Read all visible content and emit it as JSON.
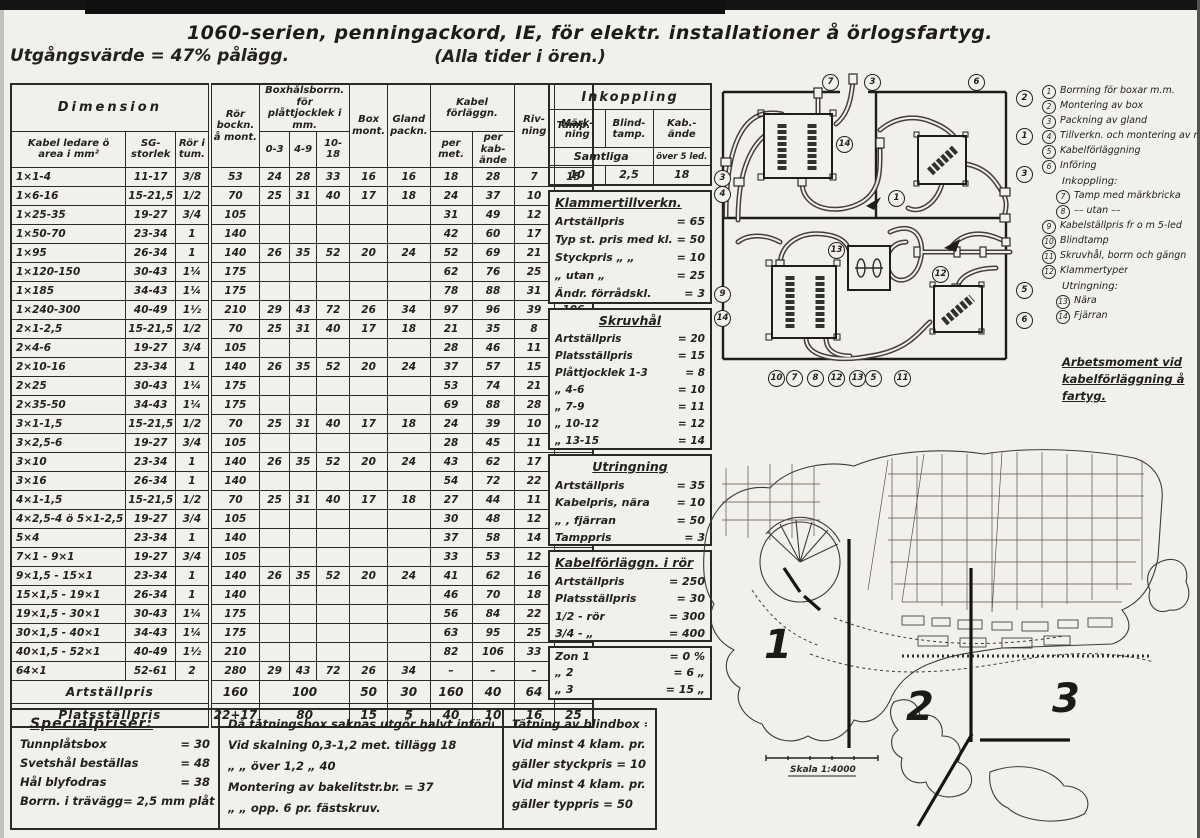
{
  "page": {
    "title_line1": "1060-serien, penningackord, IE, för elektr. installationer å örlogsfartyg.",
    "title_line2": "(Alla tider i ören.)",
    "subtitle_left": "Utgångsvärde = 47% pålägg."
  },
  "table": {
    "headers": {
      "dimension": "Dimension",
      "kabel": "Kabel ledare ö area i mm²",
      "sg": "SG-storlek",
      "ror_tum": "Rör i tum.",
      "ror_bockn": "Rör bockn. å mont.",
      "boxhal": "Boxhålsborrn. för plåttjocklek i mm.",
      "b1": "0-3",
      "b2": "4-9",
      "b3": "10-18",
      "box": "Box mont.",
      "gland": "Gland packn.",
      "kabelforlaggn": "Kabel förläggn.",
      "permet": "per met.",
      "perkab": "per kab-ände",
      "rivning": "Riv-ning",
      "tamp": "Tamp."
    },
    "rows": [
      [
        "1×1-4",
        "11-17",
        "3/8",
        "53",
        "24",
        "28",
        "33",
        "16",
        "16",
        "18",
        "28",
        "7",
        "15"
      ],
      [
        "1×6-16",
        "15-21,5",
        "1/2",
        "70",
        "25",
        "31",
        "40",
        "17",
        "18",
        "24",
        "37",
        "10",
        "19"
      ],
      [
        "1×25-35",
        "19-27",
        "3/4",
        "105",
        "",
        "",
        "",
        "",
        "",
        "31",
        "49",
        "12",
        "26"
      ],
      [
        "1×50-70",
        "23-34",
        "1",
        "140",
        "",
        "",
        "",
        "",
        "",
        "42",
        "60",
        "17",
        "38"
      ],
      [
        "1×95",
        "26-34",
        "1",
        "140",
        "26",
        "35",
        "52",
        "20",
        "24",
        "52",
        "69",
        "21",
        "50"
      ],
      [
        "1×120-150",
        "30-43",
        "1¼",
        "175",
        "",
        "",
        "",
        "",
        "",
        "62",
        "76",
        "25",
        "63"
      ],
      [
        "1×185",
        "34-43",
        "1¼",
        "175",
        "",
        "",
        "",
        "",
        "",
        "78",
        "88",
        "31",
        "85"
      ],
      [
        "1×240-300",
        "40-49",
        "1½",
        "210",
        "29",
        "43",
        "72",
        "26",
        "34",
        "97",
        "96",
        "39",
        "106"
      ],
      [
        "2×1-2,5",
        "15-21,5",
        "1/2",
        "70",
        "25",
        "31",
        "40",
        "17",
        "18",
        "21",
        "35",
        "8",
        "15"
      ],
      [
        "2×4-6",
        "19-27",
        "3/4",
        "105",
        "",
        "",
        "",
        "",
        "",
        "28",
        "46",
        "11",
        "16"
      ],
      [
        "2×10-16",
        "23-34",
        "1",
        "140",
        "26",
        "35",
        "52",
        "20",
        "24",
        "37",
        "57",
        "15",
        "19"
      ],
      [
        "2×25",
        "30-43",
        "1¼",
        "175",
        "",
        "",
        "",
        "",
        "",
        "53",
        "74",
        "21",
        "24"
      ],
      [
        "2×35-50",
        "34-43",
        "1¼",
        "175",
        "",
        "",
        "",
        "",
        "",
        "69",
        "88",
        "28",
        "30"
      ],
      [
        "3×1-1,5",
        "15-21,5",
        "1/2",
        "70",
        "25",
        "31",
        "40",
        "17",
        "18",
        "24",
        "39",
        "10",
        "15"
      ],
      [
        "3×2,5-6",
        "19-27",
        "3/4",
        "105",
        "",
        "",
        "",
        "",
        "",
        "28",
        "45",
        "11",
        "15"
      ],
      [
        "3×10",
        "23-34",
        "1",
        "140",
        "26",
        "35",
        "52",
        "20",
        "24",
        "43",
        "62",
        "17",
        "18"
      ],
      [
        "3×16",
        "26-34",
        "1",
        "140",
        "",
        "",
        "",
        "",
        "",
        "54",
        "72",
        "22",
        "20"
      ],
      [
        "4×1-1,5",
        "15-21,5",
        "1/2",
        "70",
        "25",
        "31",
        "40",
        "17",
        "18",
        "27",
        "44",
        "11",
        "15"
      ],
      [
        "4×2,5-4 ö 5×1-2,5",
        "19-27",
        "3/4",
        "105",
        "",
        "",
        "",
        "",
        "",
        "30",
        "48",
        "12",
        "15"
      ],
      [
        "5×4",
        "23-34",
        "1",
        "140",
        "",
        "",
        "",
        "",
        "",
        "37",
        "58",
        "14",
        "16"
      ],
      [
        "7×1 - 9×1",
        "19-27",
        "3/4",
        "105",
        "",
        "",
        "",
        "",
        "",
        "33",
        "53",
        "12",
        "15"
      ],
      [
        "9×1,5 - 15×1",
        "23-34",
        "1",
        "140",
        "26",
        "35",
        "52",
        "20",
        "24",
        "41",
        "62",
        "16",
        "15"
      ],
      [
        "15×1,5 - 19×1",
        "26-34",
        "1",
        "140",
        "",
        "",
        "",
        "",
        "",
        "46",
        "70",
        "18",
        "15"
      ],
      [
        "19×1,5 - 30×1",
        "30-43",
        "1¼",
        "175",
        "",
        "",
        "",
        "",
        "",
        "56",
        "84",
        "22",
        "15"
      ],
      [
        "30×1,5 - 40×1",
        "34-43",
        "1¼",
        "175",
        "",
        "",
        "",
        "",
        "",
        "63",
        "95",
        "25",
        "15"
      ],
      [
        "40×1,5 - 52×1",
        "40-49",
        "1½",
        "210",
        "",
        "",
        "",
        "",
        "",
        "82",
        "106",
        "33",
        "15"
      ],
      [
        "64×1",
        "52-61",
        "2",
        "280",
        "29",
        "43",
        "72",
        "26",
        "34",
        "–",
        "–",
        "–",
        "15"
      ]
    ],
    "summary": [
      {
        "label": "Artställpris",
        "mont": "160",
        "borr": "100",
        "cells": [
          "50",
          "30",
          "160",
          "40",
          "64",
          "100"
        ]
      },
      {
        "label": "Platsställpris",
        "mont": "22+17",
        "borr": "80",
        "cells": [
          "15",
          "5",
          "40",
          "10",
          "16",
          "25"
        ]
      }
    ]
  },
  "inkoppling": {
    "title": "Inkoppling",
    "c1": "Märk-ning",
    "c2": "Blind-tamp.",
    "c3": "Kab.-ände",
    "r1a": "Samtliga",
    "r1b": "över 5 led.",
    "r2": [
      "10",
      "2,5",
      "18"
    ]
  },
  "sections": [
    {
      "title": "Klammertillverkn.",
      "center": false,
      "items": [
        [
          "Artställpris",
          "65"
        ],
        [
          "Typ st. pris med kl. opp.",
          "50"
        ],
        [
          "Styckpris  „    „",
          "10"
        ],
        [
          "„    utan   „",
          "25"
        ],
        [
          "Ändr. förrådskl.",
          "3"
        ]
      ]
    },
    {
      "title": "Skruvhål",
      "center": true,
      "items": [
        [
          "Artställpris",
          "20"
        ],
        [
          "Platsställpris",
          "15"
        ],
        [
          "Plåttjocklek 1-3",
          "8"
        ],
        [
          "„      4-6",
          "10"
        ],
        [
          "„      7-9",
          "11"
        ],
        [
          "„      10-12",
          "12"
        ],
        [
          "„      13-15",
          "14"
        ]
      ]
    },
    {
      "title": "Utringning",
      "center": true,
      "items": [
        [
          "Artställpris",
          "35"
        ],
        [
          "Kabelpris, nära",
          "10"
        ],
        [
          "„  , fjärran",
          "50"
        ],
        [
          "Tamppris",
          "3"
        ]
      ]
    },
    {
      "title": "Kabelförläggn. i rör",
      "center": false,
      "items": [
        [
          "Artställpris",
          "250"
        ],
        [
          "Platsställpris",
          "30"
        ],
        [
          "1/2 - rör",
          "300"
        ],
        [
          "3/4 - „",
          "400"
        ]
      ]
    },
    {
      "title": "",
      "center": false,
      "items": [
        [
          "Zon 1",
          "0 %"
        ],
        [
          "„   2",
          "6 „"
        ],
        [
          "„   3",
          "15 „"
        ]
      ]
    }
  ],
  "bottom": {
    "special": {
      "title": "Specialpriser:",
      "items": [
        [
          "Tunnplåtsbox",
          "30"
        ],
        [
          "Svetshål beställas",
          "48"
        ],
        [
          "Hål blyfodras",
          "38"
        ],
        [
          "Borrn. i trävägg",
          "2,5 mm plåt"
        ]
      ]
    },
    "notes_mid": [
      "Då tätningsbox saknas utgör halvt införingspris.",
      "Vid skalning 0,3-1,2 met. tillägg 18",
      "„        „       över 1,2     „        40",
      "Montering av bakelitstr.br.  =  37",
      "„           „   opp.  6 pr. fästskruv."
    ],
    "notes_right": [
      "Tätning av blindbox = 10",
      "Vid minst 4 klam. pr. typ",
      "gäller styckpris = 10",
      "Vid minst 4 klam. pr. typ",
      "gäller typpris = 50"
    ]
  },
  "legend": {
    "items": [
      {
        "n": "1",
        "t": "Borrning för boxar m.m."
      },
      {
        "n": "2",
        "t": "Montering av box"
      },
      {
        "n": "3",
        "t": "Packning av gland"
      },
      {
        "n": "4",
        "t": "Tillverkn. och montering av rör"
      },
      {
        "n": "5",
        "t": "Kabelförläggning"
      },
      {
        "n": "6",
        "t": "Införing"
      },
      {
        "h": "Inkoppling:"
      },
      {
        "n": "7",
        "t": "Tamp med märkbricka",
        "ind": true
      },
      {
        "n": "8",
        "t": "––  utan  ––",
        "ind": true
      },
      {
        "n": "9",
        "t": "Kabelställpris fr o m 5-led"
      },
      {
        "n": "10",
        "t": "Blindtamp"
      },
      {
        "n": "11",
        "t": "Skruvhål, borrn och gängn"
      },
      {
        "n": "12",
        "t": "Klammertyper"
      },
      {
        "h": "Utringning:"
      },
      {
        "n": "13",
        "t": "Nära",
        "ind": true
      },
      {
        "n": "14",
        "t": "Fjärran",
        "ind": true
      }
    ],
    "note": [
      "Arbetsmoment vid",
      "kabelförläggning å",
      "fartyg."
    ]
  },
  "diagram": {
    "callouts": [
      {
        "n": "7",
        "x": 104,
        "y": 4
      },
      {
        "n": "3",
        "x": 146,
        "y": 4
      },
      {
        "n": "6",
        "x": 250,
        "y": 4
      },
      {
        "n": "2",
        "x": 298,
        "y": 20
      },
      {
        "n": "1",
        "x": 298,
        "y": 58
      },
      {
        "n": "3",
        "x": 298,
        "y": 96
      },
      {
        "n": "14",
        "x": 118,
        "y": 66
      },
      {
        "n": "1",
        "x": 170,
        "y": 120
      },
      {
        "n": "3",
        "x": -4,
        "y": 100
      },
      {
        "n": "4",
        "x": -4,
        "y": 116
      },
      {
        "n": "9",
        "x": -4,
        "y": 216
      },
      {
        "n": "14",
        "x": -4,
        "y": 240
      },
      {
        "n": "13",
        "x": 110,
        "y": 172
      },
      {
        "n": "12",
        "x": 214,
        "y": 196
      },
      {
        "n": "5",
        "x": 298,
        "y": 212
      },
      {
        "n": "6",
        "x": 298,
        "y": 242
      },
      {
        "n": "10",
        "x": 50,
        "y": 300
      },
      {
        "n": "7",
        "x": 68,
        "y": 300
      },
      {
        "n": "8",
        "x": 89,
        "y": 300
      },
      {
        "n": "12",
        "x": 110,
        "y": 300
      },
      {
        "n": "13",
        "x": 131,
        "y": 300
      },
      {
        "n": "5",
        "x": 147,
        "y": 300
      },
      {
        "n": "11",
        "x": 176,
        "y": 300
      }
    ]
  },
  "map": {
    "zones": [
      "1",
      "2",
      "3"
    ],
    "scale": "Skala 1:4000"
  }
}
